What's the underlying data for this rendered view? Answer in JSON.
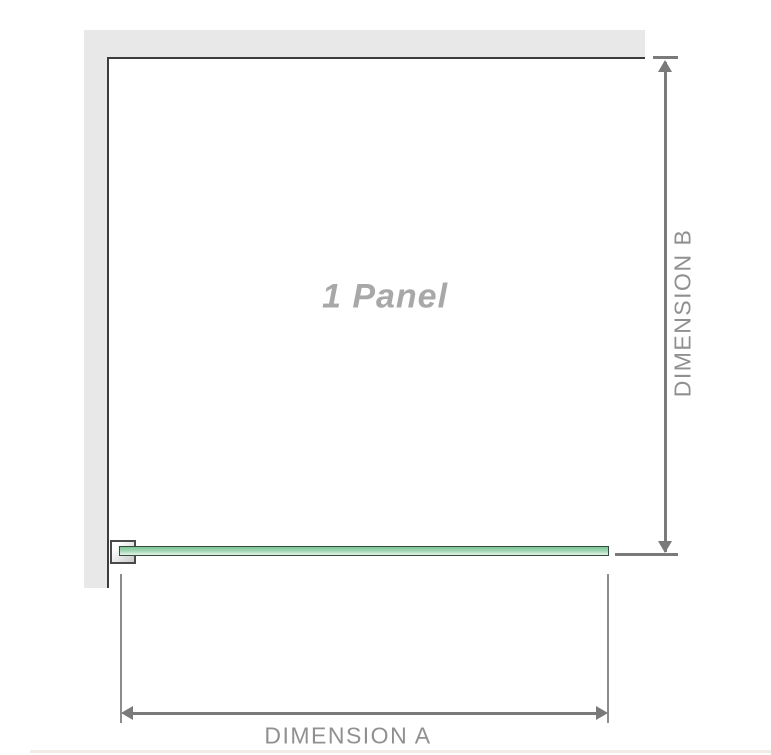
{
  "diagram": {
    "title": "1 Panel",
    "dimension_a": {
      "label": "DIMENSION A",
      "orientation": "horizontal"
    },
    "dimension_b": {
      "label": "DIMENSION B",
      "orientation": "vertical"
    },
    "components": {
      "wall": "l-shaped-wall-top-left",
      "glass_panel": "single-glass-panel-plan-view",
      "bracket": "wall-mount-bracket"
    }
  },
  "colors": {
    "wall_fill": "#e8e8e8",
    "wall_edge": "#3d3d3d",
    "dimension_line": "#7a7a7a",
    "extension_line": "#8c8c8c",
    "dimension_text": "#909090",
    "panel_label_text": "#a8a8a8",
    "glass_fill_dark": "#7cc596",
    "glass_fill_light": "#e3f3e8",
    "glass_border": "#354b3d",
    "bracket_border": "#4a4a4a"
  }
}
